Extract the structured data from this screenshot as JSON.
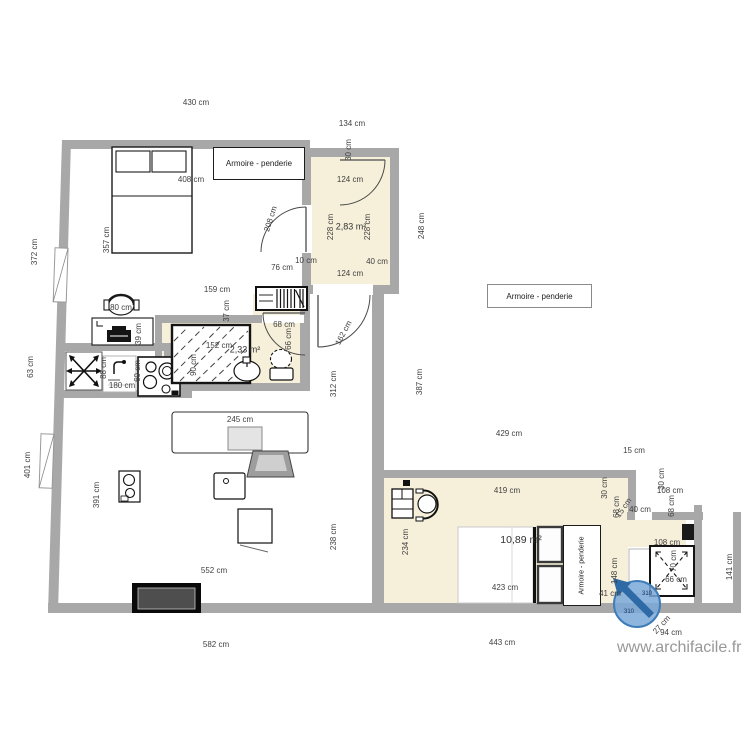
{
  "plan": {
    "watermark": "www.archifacile.fr",
    "compass_bearing": "310",
    "wardrobe_label": "Armoire - penderie"
  },
  "labels": [
    {
      "t": "430 cm"
    },
    {
      "t": "134 cm"
    },
    {
      "t": "30 cm"
    },
    {
      "t": "408 cm"
    },
    {
      "t": "124 cm"
    },
    {
      "t": "228 cm"
    },
    {
      "t": "2,83 m²"
    },
    {
      "t": "228 cm"
    },
    {
      "t": "248 cm"
    },
    {
      "t": "208 cm"
    },
    {
      "t": "357 cm"
    },
    {
      "t": "372 cm"
    },
    {
      "t": "124 cm"
    },
    {
      "t": "10 cm"
    },
    {
      "t": "40 cm"
    },
    {
      "t": "76 cm"
    },
    {
      "t": "159 cm"
    },
    {
      "t": "37 cm"
    },
    {
      "t": "68 cm"
    },
    {
      "t": "66 cm"
    },
    {
      "t": "162 cm"
    },
    {
      "t": "312 cm"
    },
    {
      "t": "387 cm"
    },
    {
      "t": "152 cm"
    },
    {
      "t": "2,33 m²"
    },
    {
      "t": "90 cm"
    },
    {
      "t": "88 cm"
    },
    {
      "t": "60 cm"
    },
    {
      "t": "180 cm"
    },
    {
      "t": "80 cm"
    },
    {
      "t": "39 cm"
    },
    {
      "t": "63 cm"
    },
    {
      "t": "401 cm"
    },
    {
      "t": "391 cm"
    },
    {
      "t": "245 cm"
    },
    {
      "t": "238 cm"
    },
    {
      "t": "552 cm"
    },
    {
      "t": "582 cm"
    },
    {
      "t": "429 cm"
    },
    {
      "t": "15 cm"
    },
    {
      "t": "30 cm"
    },
    {
      "t": "30 cm"
    },
    {
      "t": "108 cm"
    },
    {
      "t": "68 cm"
    },
    {
      "t": "68 cm"
    },
    {
      "t": "15 cm"
    },
    {
      "t": "40 cm"
    },
    {
      "t": "419 cm"
    },
    {
      "t": "234 cm"
    },
    {
      "t": "10,89 m²"
    },
    {
      "t": "423 cm"
    },
    {
      "t": "148 cm"
    },
    {
      "t": "108 cm"
    },
    {
      "t": "70 cm"
    },
    {
      "t": "66 cm"
    },
    {
      "t": "141 cm"
    },
    {
      "t": "41 cm"
    },
    {
      "t": "27 cm"
    },
    {
      "t": "94 cm"
    },
    {
      "t": "443 cm"
    }
  ]
}
